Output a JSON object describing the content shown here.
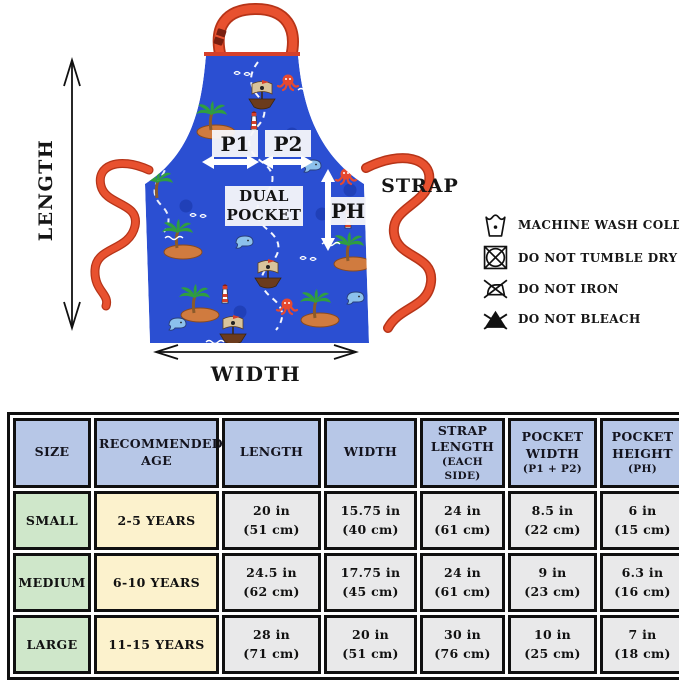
{
  "diagram": {
    "length_label": "LENGTH",
    "width_label": "WIDTH",
    "strap_label": "STRAP",
    "p1_label": "P1",
    "p2_label": "P2",
    "dual_pocket_label": "DUAL POCKET",
    "ph_label": "PH"
  },
  "care_instructions": [
    {
      "icon": "machine-wash-cold-icon",
      "label": "MACHINE WASH COLD"
    },
    {
      "icon": "do-not-tumble-dry-icon",
      "label": "DO NOT TUMBLE DRY"
    },
    {
      "icon": "do-not-iron-icon",
      "label": "DO NOT IRON"
    },
    {
      "icon": "do-not-bleach-icon",
      "label": "DO NOT BLEACH"
    }
  ],
  "size_table": {
    "headers": [
      {
        "title": "SIZE",
        "sub": ""
      },
      {
        "title": "RECOMMENDED AGE",
        "sub": ""
      },
      {
        "title": "LENGTH",
        "sub": ""
      },
      {
        "title": "WIDTH",
        "sub": ""
      },
      {
        "title": "STRAP LENGTH",
        "sub": "(EACH SIDE)"
      },
      {
        "title": "POCKET WIDTH",
        "sub": "(P1 + P2)"
      },
      {
        "title": "POCKET HEIGHT",
        "sub": "(PH)"
      }
    ],
    "rows": [
      {
        "size": "SMALL",
        "age": "2-5 YEARS",
        "cells": [
          [
            "20 in",
            "(51 cm)"
          ],
          [
            "15.75 in",
            "(40 cm)"
          ],
          [
            "24 in",
            "(61 cm)"
          ],
          [
            "8.5 in",
            "(22 cm)"
          ],
          [
            "6 in",
            "(15 cm)"
          ]
        ]
      },
      {
        "size": "MEDIUM",
        "age": "6-10 YEARS",
        "cells": [
          [
            "24.5 in",
            "(62 cm)"
          ],
          [
            "17.75 in",
            "(45 cm)"
          ],
          [
            "24 in",
            "(61 cm)"
          ],
          [
            "9 in",
            "(23 cm)"
          ],
          [
            "6.3 in",
            "(16 cm)"
          ]
        ]
      },
      {
        "size": "LARGE",
        "age": "11-15 YEARS",
        "cells": [
          [
            "28 in",
            "(71 cm)"
          ],
          [
            "20 in",
            "(51 cm)"
          ],
          [
            "30 in",
            "(76 cm)"
          ],
          [
            "10 in",
            "(25 cm)"
          ],
          [
            "7 in",
            "(18 cm)"
          ]
        ]
      }
    ]
  },
  "colors": {
    "apron_blue": "#2b4fd2",
    "strap_red": "#e14a2b",
    "table_header_bg": "#b7c7e7",
    "size_col_bg": "#cfe7ca",
    "age_col_bg": "#fcf2cd",
    "value_cell_bg": "#e9e9ea",
    "table_border": "#101010"
  }
}
